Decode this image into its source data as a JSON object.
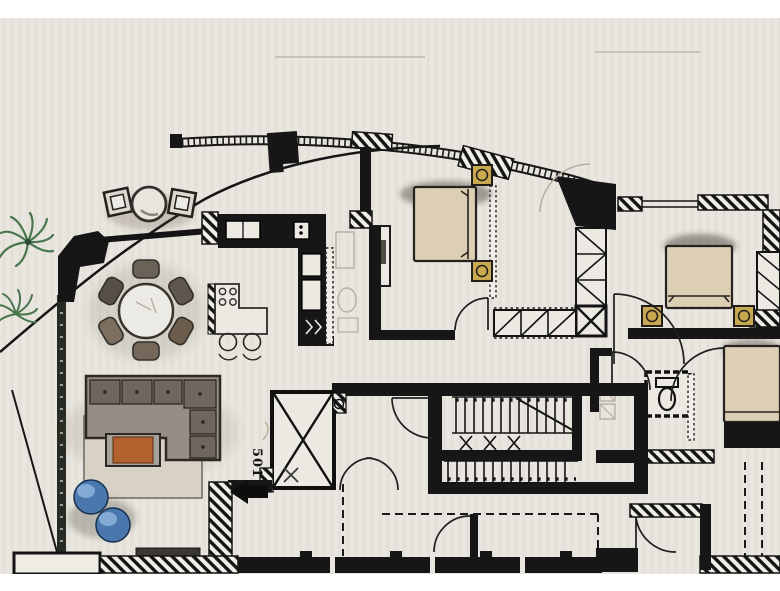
{
  "document": {
    "kind": "Scanned hand-rendered apartment floor plan",
    "media": "pencil and marker on paper, photographed"
  },
  "annotations": {
    "unit_label": "501",
    "entry_arrow_direction": "left"
  },
  "drawing_conventions": {
    "solid_walls": "black poche",
    "hatched_walls": "diagonal hatch",
    "stud_walls": "dotted outline",
    "glazing": "curved facade band with mullion ticks",
    "doors": "quarter-circle swings",
    "shaft": "X-braced box"
  },
  "rooms": [
    {
      "id": "terrace",
      "label": "Curved terrace",
      "furniture": [
        "round bistro table",
        "2 outdoor chairs",
        "palm plant"
      ]
    },
    {
      "id": "living-room",
      "label": "Living room",
      "furniture": [
        "L-shaped tufted sofa",
        "coffee table",
        "area rug",
        "2 round poufs",
        "TV console"
      ]
    },
    {
      "id": "dining-area",
      "label": "Dining area",
      "furniture": [
        "round dining table",
        "6 chairs"
      ]
    },
    {
      "id": "kitchen",
      "label": "Kitchen",
      "furniture": [
        "counter with sink",
        "built-in appliances",
        "island with 4-burner cooktop",
        "2 bar stools"
      ]
    },
    {
      "id": "bedroom-1",
      "label": "Bedroom top-centre",
      "furniture": [
        "double bed",
        "2 gold nightstands",
        "closet wall"
      ]
    },
    {
      "id": "bedroom-2",
      "label": "Bedroom right",
      "furniture": [
        "double bed",
        "2 gold nightstands",
        "wardrobe"
      ]
    },
    {
      "id": "bedroom-3",
      "label": "Bedroom bottom-right (cropped)",
      "furniture": [
        "double bed"
      ]
    },
    {
      "id": "bathroom",
      "label": "Bathroom",
      "furniture": [
        "toilet",
        "vanity"
      ]
    },
    {
      "id": "stair-core",
      "label": "Stair core",
      "furniture": [
        "two stair flights",
        "central handrail",
        "landing"
      ]
    },
    {
      "id": "service-shaft",
      "label": "Service shaft",
      "furniture": [
        "X-braced shaft"
      ]
    },
    {
      "id": "entry",
      "label": "Entry",
      "furniture": [
        "unit number marker",
        "entry arrow",
        "double swing door"
      ]
    }
  ],
  "colors": {
    "paper": "#e9e6e0",
    "margin": "#ffffff",
    "ink": "#161616",
    "bed_tan": "#ddcfb4",
    "nightstand_gold": "#c8a850",
    "sofa_base": "#968e84",
    "sofa_cushion": "#6f675d",
    "rug": "#d8d1c5",
    "coffee_table_orange": "#b2602c",
    "pouf_blue": "#4a77ad",
    "pouf_highlight": "#8db3dc",
    "palm_green": "#47754c"
  }
}
